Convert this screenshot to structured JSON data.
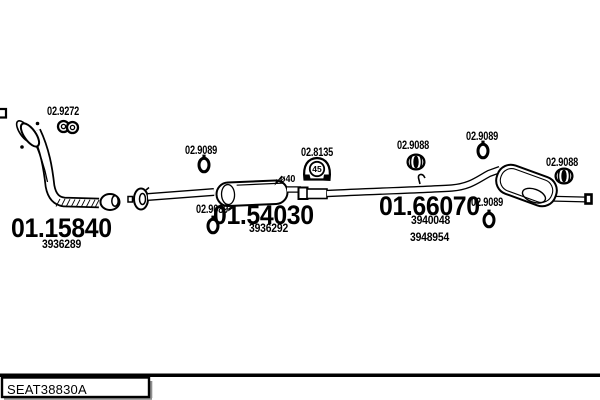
{
  "footer": {
    "code": "SEAT38830A"
  },
  "annotations": {
    "diameter": "ø40"
  },
  "parts": [
    {
      "number": "01.15840",
      "refs": [
        "3936289"
      ]
    },
    {
      "number": "01.54030",
      "refs": [
        "3936292"
      ]
    },
    {
      "number": "01.66070",
      "refs": [
        "3940048",
        "3948954"
      ]
    }
  ],
  "fittings": [
    {
      "number": "02.9272",
      "type": "clamp"
    },
    {
      "number": "02.9089",
      "type": "rubber-ring"
    },
    {
      "number": "02.8135",
      "type": "rubber-mount",
      "size_mark": "45"
    },
    {
      "number": "02.9088",
      "type": "clamp"
    },
    {
      "number": "02.9089",
      "type": "rubber-ring"
    },
    {
      "number": "02.9088",
      "type": "clamp"
    },
    {
      "number": "02.9089",
      "type": "rubber-ring"
    },
    {
      "number": "02.9089",
      "type": "rubber-ring"
    }
  ],
  "colors": {
    "ink": "#000000",
    "paper": "#ffffff",
    "shadow": "#8f8f8f"
  }
}
